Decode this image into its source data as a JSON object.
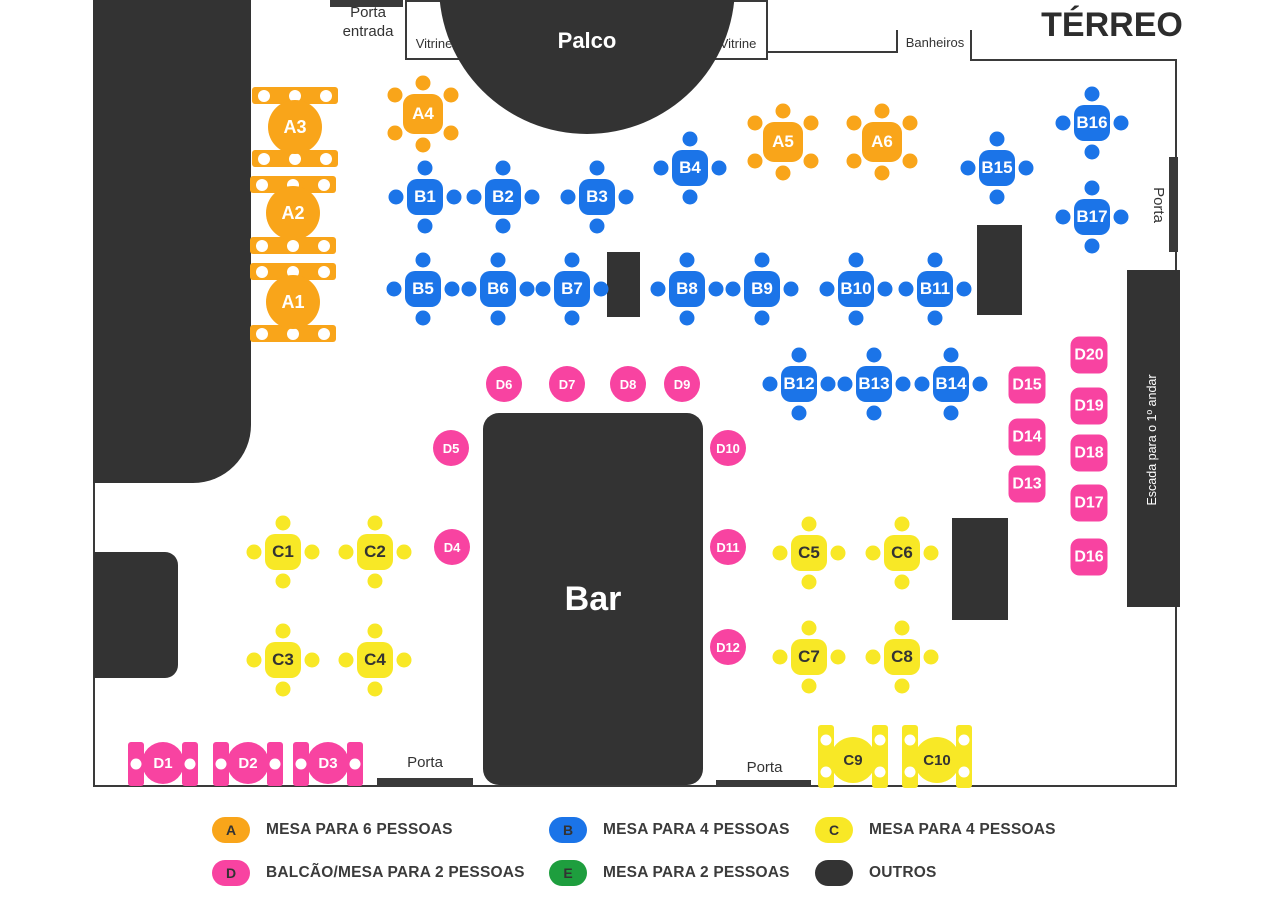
{
  "title": "TÉRREO",
  "areas": {
    "palco": "Palco",
    "bar": "Bar",
    "escada": "Escada para o 1º andar",
    "vitrine_left": "Vitrine",
    "vitrine_right": "Vitrine",
    "banheiros": "Banheiros"
  },
  "doors": {
    "entrada": "Porta entrada",
    "right": "Porta",
    "bottom_left": "Porta",
    "bottom_right": "Porta"
  },
  "tables": {
    "a_round": [
      "A1",
      "A2",
      "A3"
    ],
    "a_square": [
      "A4",
      "A5",
      "A6"
    ],
    "b": [
      "B1",
      "B2",
      "B3",
      "B4",
      "B5",
      "B6",
      "B7",
      "B8",
      "B9",
      "B10",
      "B11",
      "B12",
      "B13",
      "B14",
      "B15",
      "B16",
      "B17"
    ],
    "c": [
      "C1",
      "C2",
      "C3",
      "C4",
      "C5",
      "C6",
      "C7",
      "C8"
    ],
    "c_counter": [
      "C9",
      "C10"
    ],
    "d_counter": [
      "D1",
      "D2",
      "D3"
    ],
    "d_round": [
      "D4",
      "D5",
      "D6",
      "D7",
      "D8",
      "D9",
      "D10",
      "D11",
      "D12"
    ],
    "d_square": [
      "D13",
      "D14",
      "D15",
      "D16",
      "D17",
      "D18",
      "D19",
      "D20"
    ]
  },
  "legend": [
    {
      "letter": "A",
      "label": "MESA PARA 6 PESSOAS",
      "color": "#F9A51A"
    },
    {
      "letter": "B",
      "label": "MESA PARA 4 PESSOAS",
      "color": "#1B74E8"
    },
    {
      "letter": "C",
      "label": "MESA PARA 4 PESSOAS",
      "color": "#F8E826"
    },
    {
      "letter": "D",
      "label": "BALCÃO/MESA PARA 2 PESSOAS",
      "color": "#F843A1"
    },
    {
      "letter": "E",
      "label": "MESA PARA 2 PESSOAS",
      "color": "#1E9E3E"
    },
    {
      "letter": "",
      "label": "OUTROS",
      "color": "#333333"
    }
  ],
  "colors": {
    "orange": "#F9A51A",
    "blue": "#1B74E8",
    "yellow": "#F8E826",
    "pink": "#F843A1",
    "green": "#1E9E3E",
    "dark": "#333333",
    "wall": "#3a3a3a"
  }
}
